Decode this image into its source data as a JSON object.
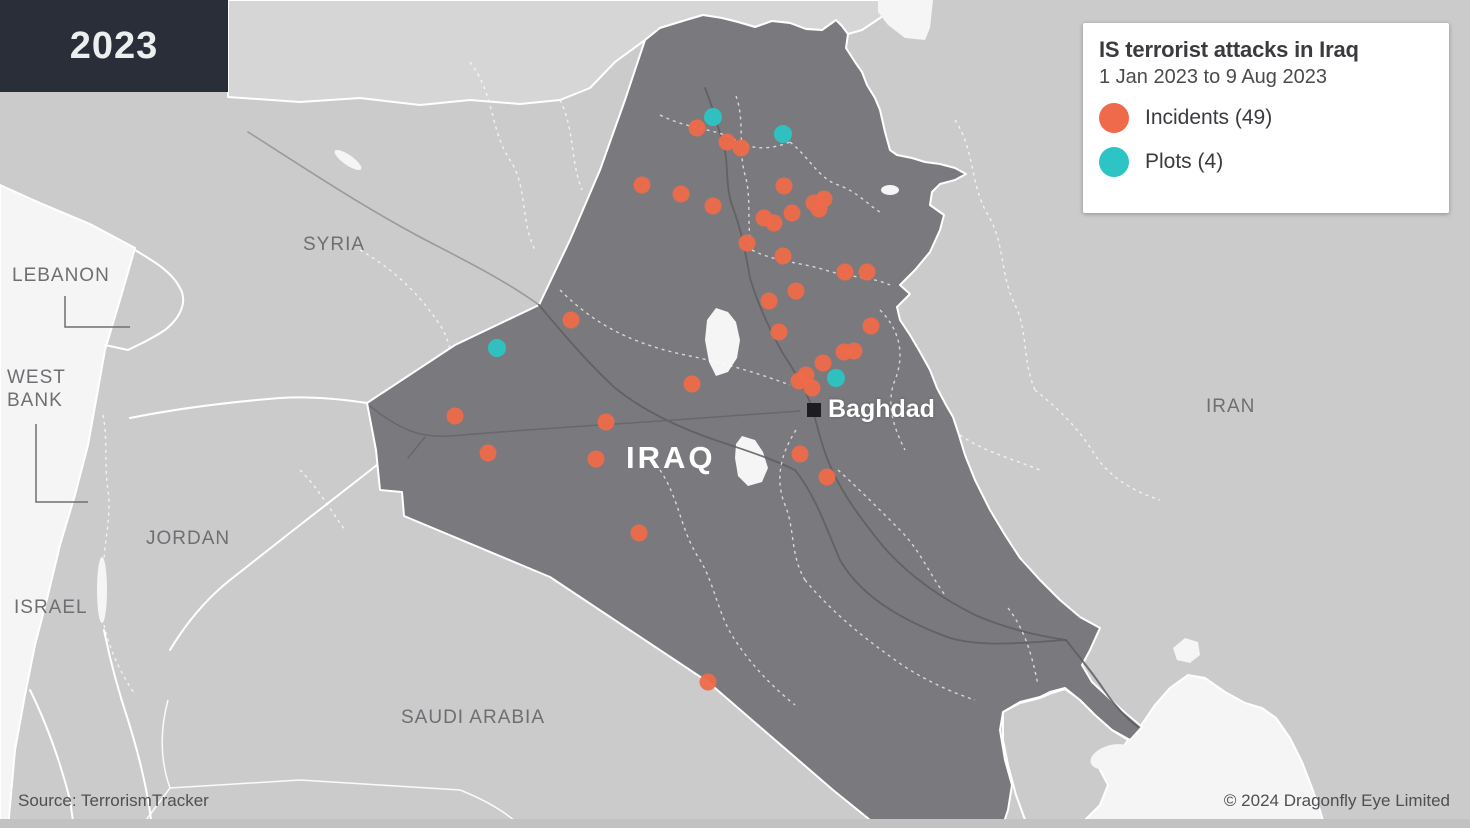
{
  "year_badge": "2023",
  "legend": {
    "title": "IS terrorist attacks in Iraq",
    "date_range": "1 Jan 2023 to 9 Aug 2023",
    "items": [
      {
        "label": "Incidents (49)",
        "color": "#ee6a4a",
        "count": 49
      },
      {
        "label": "Plots (4)",
        "color": "#2cc4c4",
        "count": 4
      }
    ]
  },
  "map": {
    "labels": {
      "lebanon": "LEBANON",
      "west_bank": "WEST\nBANK",
      "israel": "ISRAEL",
      "jordan": "JORDAN",
      "syria": "SYRIA",
      "saudi_arabia": "SAUDI ARABIA",
      "iran": "IRAN",
      "iraq": "IRAQ"
    },
    "city": {
      "name": "Baghdad"
    },
    "colors": {
      "incident": "#ee6a4a",
      "plot": "#2cc4c4",
      "iraq_fill": "#7a7a7e",
      "land": "#cbcbcb",
      "water": "#f5f5f5"
    },
    "incident_points": [
      [
        697,
        128
      ],
      [
        727,
        142
      ],
      [
        741,
        148
      ],
      [
        642,
        185
      ],
      [
        681,
        194
      ],
      [
        713,
        206
      ],
      [
        784,
        186
      ],
      [
        814,
        203
      ],
      [
        824,
        199
      ],
      [
        819,
        209
      ],
      [
        764,
        218
      ],
      [
        774,
        223
      ],
      [
        792,
        213
      ],
      [
        747,
        243
      ],
      [
        783,
        256
      ],
      [
        845,
        272
      ],
      [
        867,
        272
      ],
      [
        796,
        291
      ],
      [
        769,
        301
      ],
      [
        871,
        326
      ],
      [
        779,
        332
      ],
      [
        571,
        320
      ],
      [
        692,
        384
      ],
      [
        844,
        352
      ],
      [
        854,
        351
      ],
      [
        823,
        363
      ],
      [
        806,
        375
      ],
      [
        812,
        388
      ],
      [
        799,
        381
      ],
      [
        455,
        416
      ],
      [
        606,
        422
      ],
      [
        488,
        453
      ],
      [
        596,
        459
      ],
      [
        800,
        454
      ],
      [
        827,
        477
      ],
      [
        639,
        533
      ],
      [
        708,
        682
      ]
    ],
    "plot_points": [
      [
        713,
        117
      ],
      [
        783,
        134
      ],
      [
        497,
        348
      ],
      [
        836,
        378
      ]
    ]
  },
  "footer": {
    "source": "Source: TerrorismTracker",
    "copyright": "© 2024 Dragonfly Eye Limited"
  }
}
